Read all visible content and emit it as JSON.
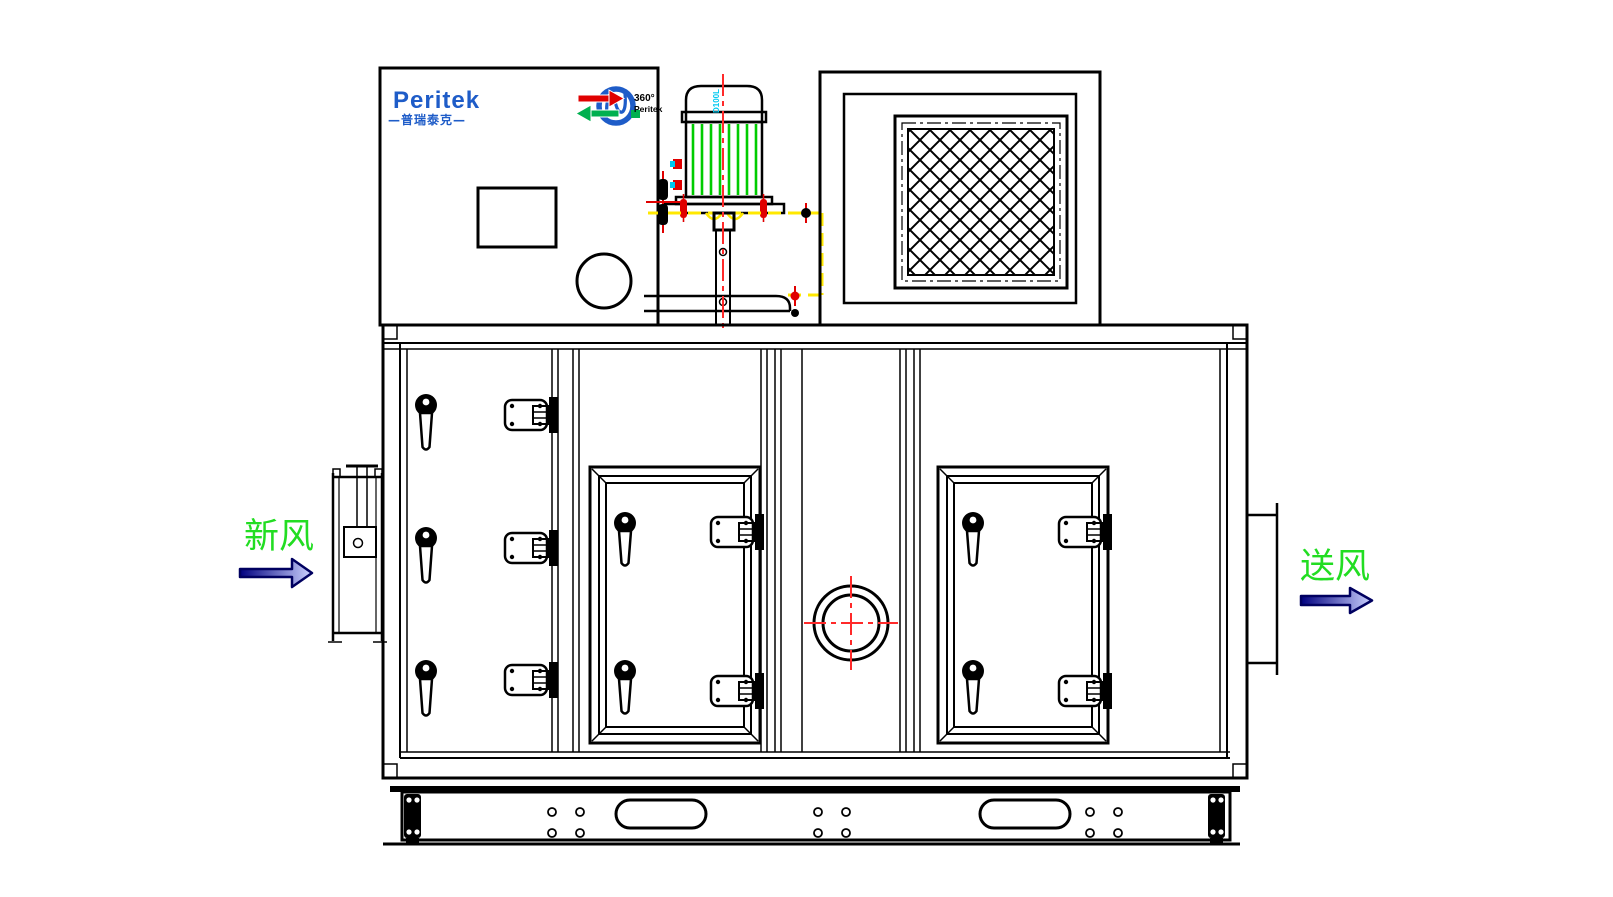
{
  "drawing": {
    "type": "cad-front-elevation",
    "brand": {
      "name": "Peritek",
      "chinese_name": "—普瑞泰克—"
    },
    "rotor_logo": {
      "degree_text": "360°",
      "brand_text": "Peritek"
    },
    "motor": {
      "model_label": "D100L"
    },
    "airflow": {
      "inlet_label": "新风",
      "outlet_label": "送风"
    }
  },
  "colors": {
    "line_black": "#000000",
    "brand_blue": "#1e5cc8",
    "centerline_red": "#ff2a2a",
    "bolt_red": "#e00000",
    "fin_green": "#00cc00",
    "label_green": "#22dd22",
    "datum_yellow": "#ffe800",
    "accent_cyan": "#00c8f0",
    "arrow_dark_blue": "#000080",
    "arrow_light_blue": "#ccd2ff"
  }
}
